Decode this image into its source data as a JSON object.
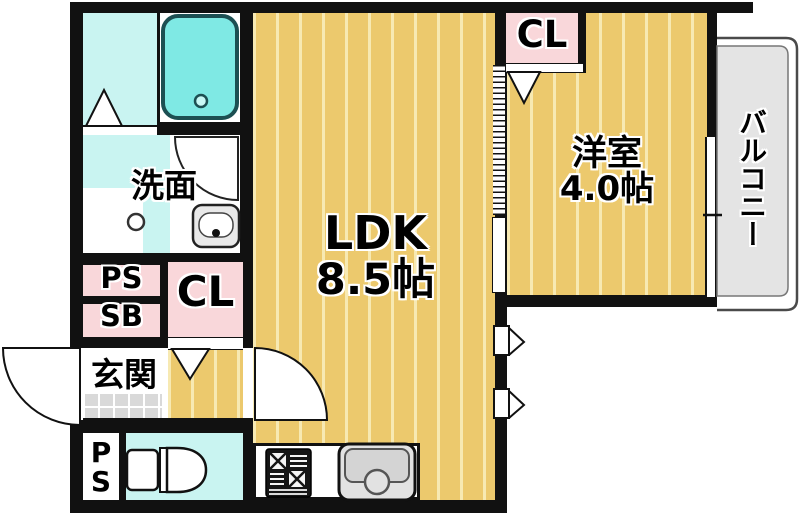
{
  "labels": {
    "ldk": {
      "name": "LDK",
      "size": "8.5帖"
    },
    "western_room": {
      "name": "洋室",
      "size": "4.0帖"
    },
    "washroom": "洗面",
    "entrance": "玄関",
    "balcony": "バルコニー",
    "closet_bedroom": "CL",
    "closet_hall": "CL",
    "pipe_space_upper": "PS",
    "shoe_box": "SB",
    "pipe_space_lower": "PS"
  },
  "colors": {
    "wall": "#111111",
    "wood_floor": "#ecc96d",
    "wood_floor_stripe": "#f7e9b2",
    "wet_area_floor": "#c9f4f1",
    "bathtub_fill": "#7fe9e4",
    "closet_pink": "#f9d7da",
    "balcony_gray": "#e4e4e4",
    "entrance_tile_gray": "#d9d9d9",
    "fixture_gray": "#d8d8d8"
  },
  "icons": {
    "bathtub": "bathtub-icon",
    "bathroom_door": "folding-door-triangle-icon",
    "washbasin": "washbasin-icon",
    "washer_pan_drain": "washer-drain-icon",
    "toilet": "toilet-icon",
    "gas_stove": "gas-stove-icon",
    "kitchen_sink": "kitchen-sink-icon",
    "entrance_door": "door-swing-arc-icon",
    "ldk_door": "door-swing-arc-icon",
    "washroom_door": "door-swing-arc-icon",
    "closet_doors": "folding-door-v-icon",
    "partition": "accordion-partition-icon",
    "windows": "window-icon"
  }
}
